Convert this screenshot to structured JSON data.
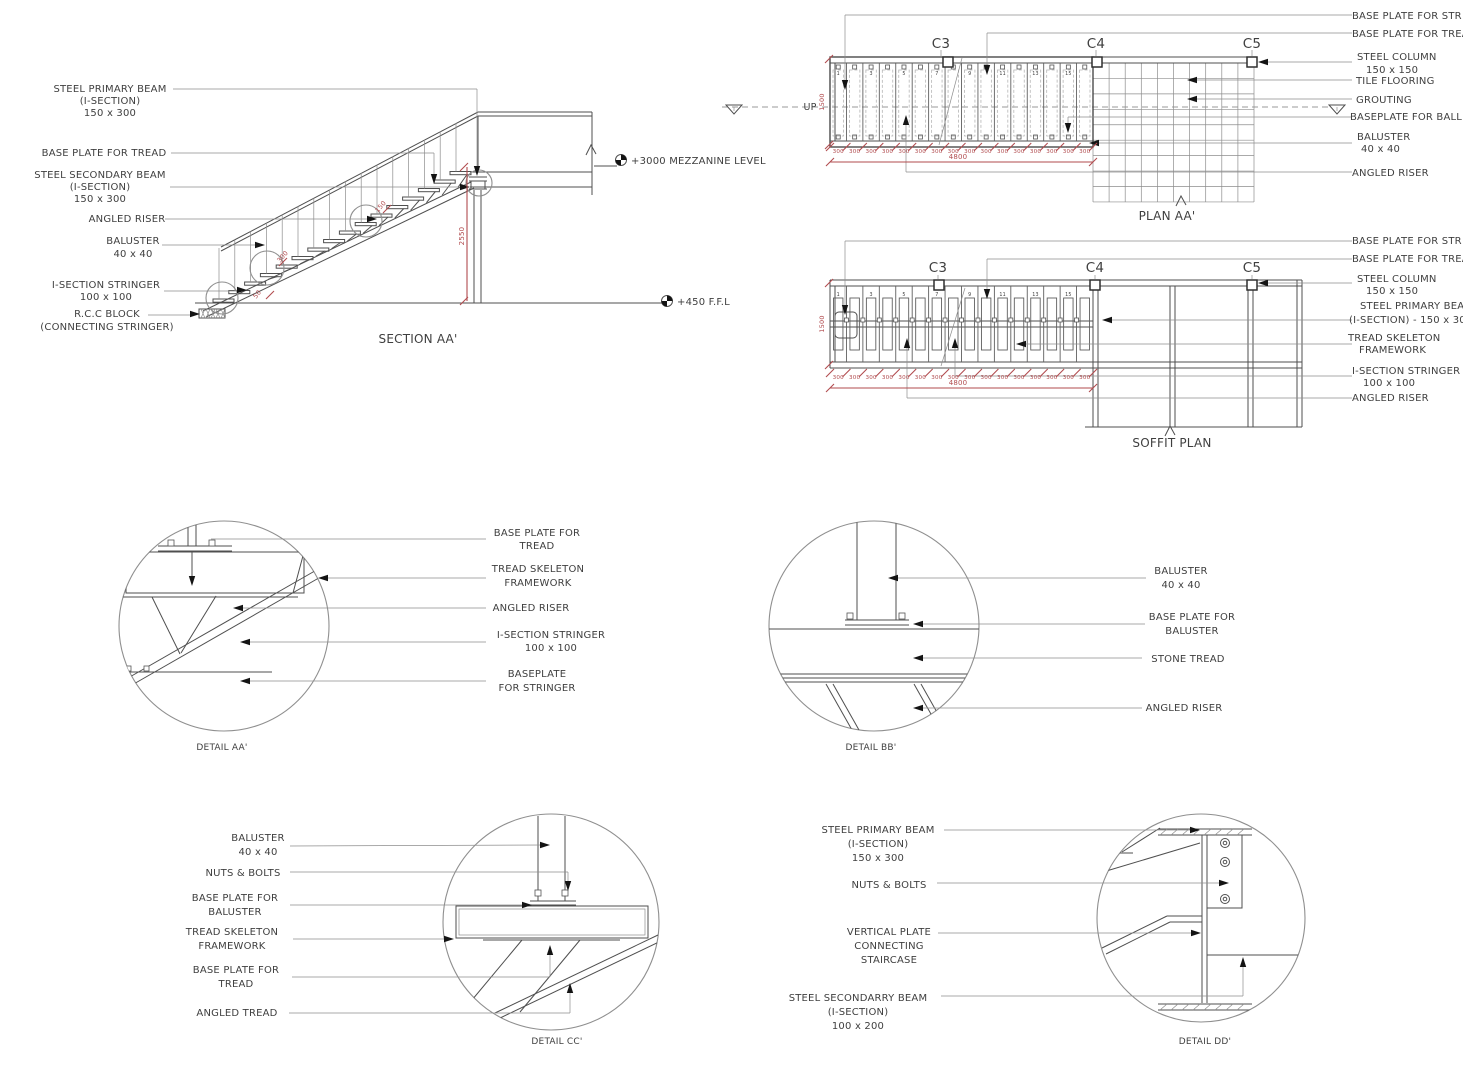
{
  "meta": {
    "background": "#ffffff",
    "line_color": "#4f4f4f",
    "dim_color": "#b14b4e",
    "text_color": "#3f3f3f"
  },
  "section_aa": {
    "title": "SECTION AA'",
    "labels": {
      "primary_beam": [
        "STEEL PRIMARY BEAM",
        "(I-SECTION)",
        "150 x 300"
      ],
      "base_plate_tread": "BASE PLATE FOR TREAD",
      "secondary_beam": [
        "STEEL SECONDARY BEAM",
        "(I-SECTION)",
        "150 x 300"
      ],
      "angled_riser": "ANGLED RISER",
      "baluster": [
        "BALUSTER",
        "40 x 40"
      ],
      "stringer": [
        "I-SECTION STRINGER",
        "100 x 100"
      ],
      "rcc_block": [
        "R.C.C BLOCK",
        "(CONNECTING STRINGER)"
      ]
    },
    "levels": {
      "mezzanine": "+3000 MEZZANINE LEVEL",
      "ffl": "+450 F.F.L"
    },
    "dims": {
      "height": "2550",
      "d50": "50",
      "d300": "300",
      "d150": "150"
    }
  },
  "plan_aa": {
    "title": "PLAN AA'",
    "up_label": "UP",
    "columns": [
      "C3",
      "C4",
      "C5"
    ],
    "tread_numbers": [
      "1",
      "3",
      "5",
      "7",
      "9",
      "11",
      "13",
      "15"
    ],
    "tread_count": 16,
    "tread_dim": "300",
    "total_dim": "4800",
    "width_dim": "1500",
    "labels": {
      "base_plate_stringer": "BASE PLATE FOR STR",
      "base_plate_tread": "BASE PLATE FOR TREA",
      "steel_column": [
        "STEEL COLUMN",
        "150 x 150"
      ],
      "tile_flooring": "TILE FLOORING",
      "grouting": "GROUTING",
      "baseplate_baluster": "BASEPLATE FOR BALL",
      "baluster": [
        "BALUSTER",
        "40 x 40"
      ],
      "angled_riser": "ANGLED RISER"
    }
  },
  "soffit_plan": {
    "title": "SOFFIT PLAN",
    "columns": [
      "C3",
      "C4",
      "C5"
    ],
    "tread_numbers": [
      "1",
      "3",
      "5",
      "7",
      "9",
      "11",
      "13",
      "15"
    ],
    "tread_count": 16,
    "tread_dim": "300",
    "total_dim": "4800",
    "width_dim": "1500",
    "labels": {
      "base_plate_stringer": "BASE PLATE FOR STR",
      "base_plate_tread": "BASE PLATE FOR TREA",
      "steel_column": [
        "STEEL COLUMN",
        "150 x 150"
      ],
      "primary_beam": [
        "STEEL PRIMARY BEA",
        "(I-SECTION) - 150 x 30"
      ],
      "tread_skeleton": [
        "TREAD SKELETON",
        "FRAMEWORK"
      ],
      "stringer": [
        "I-SECTION STRINGER",
        "100 x 100"
      ],
      "angled_riser": "ANGLED RISER"
    }
  },
  "detail_aa": {
    "title": "DETAIL AA'",
    "labels": {
      "base_plate_tread": [
        "BASE PLATE FOR",
        "TREAD"
      ],
      "tread_skeleton": [
        "TREAD SKELETON",
        "FRAMEWORK"
      ],
      "angled_riser": "ANGLED RISER",
      "stringer": [
        "I-SECTION STRINGER",
        "100 x 100"
      ],
      "baseplate_stringer": [
        "BASEPLATE",
        "FOR STRINGER"
      ]
    }
  },
  "detail_bb": {
    "title": "DETAIL BB'",
    "labels": {
      "baluster": [
        "BALUSTER",
        "40 x 40"
      ],
      "base_plate_baluster": [
        "BASE PLATE FOR",
        "BALUSTER"
      ],
      "stone_tread": "STONE TREAD",
      "angled_riser": "ANGLED RISER"
    }
  },
  "detail_cc": {
    "title": "DETAIL CC'",
    "labels": {
      "baluster": [
        "BALUSTER",
        "40 x 40"
      ],
      "nuts_bolts": "NUTS & BOLTS",
      "base_plate_baluster": [
        "BASE PLATE FOR",
        "BALUSTER"
      ],
      "tread_skeleton": [
        "TREAD SKELETON",
        "FRAMEWORK"
      ],
      "base_plate_tread": [
        "BASE PLATE FOR",
        "TREAD"
      ],
      "angled_tread": "ANGLED TREAD"
    }
  },
  "detail_dd": {
    "title": "DETAIL DD'",
    "labels": {
      "primary_beam": [
        "STEEL PRIMARY BEAM",
        "(I-SECTION)",
        "150 x 300"
      ],
      "nuts_bolts": "NUTS & BOLTS",
      "vertical_plate": [
        "VERTICAL PLATE",
        "CONNECTING",
        "STAIRCASE"
      ],
      "secondary_beam": [
        "STEEL SECONDARRY BEAM",
        "(I-SECTION)",
        "100 x 200"
      ]
    }
  }
}
